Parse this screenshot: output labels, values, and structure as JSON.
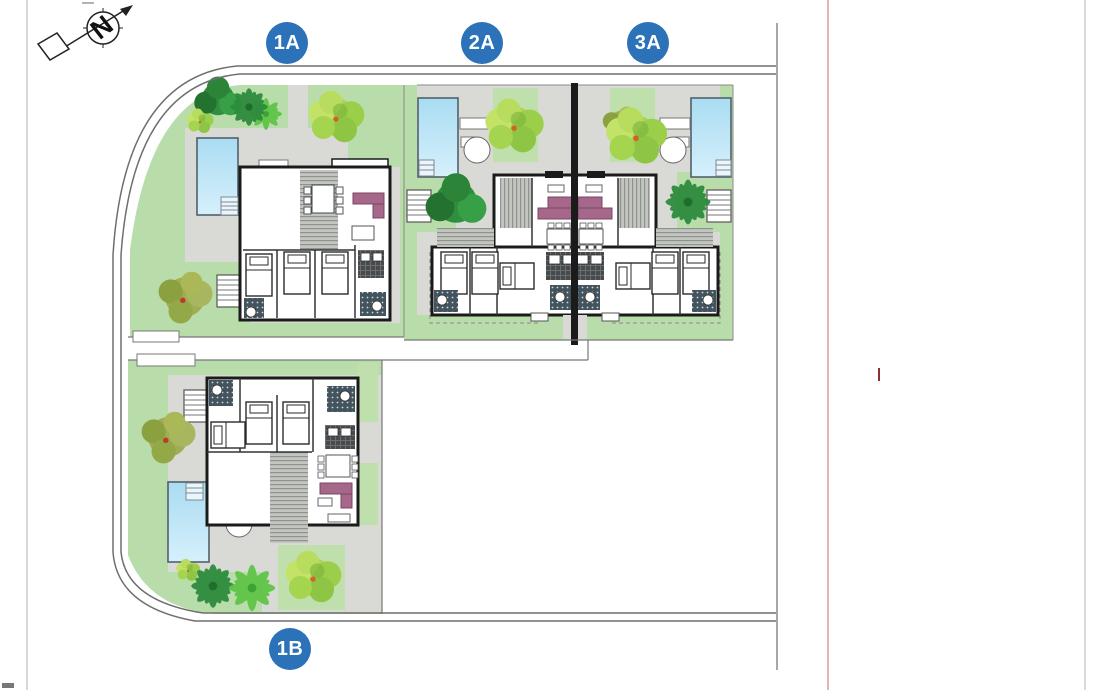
{
  "site_plan": {
    "compass": {
      "north_label": "N"
    },
    "units": [
      {
        "id": "unit-1a",
        "label": "1A"
      },
      {
        "id": "unit-2a",
        "label": "2A"
      },
      {
        "id": "unit-3a",
        "label": "3A"
      },
      {
        "id": "unit-1b",
        "label": "1B"
      }
    ]
  },
  "colors": {
    "accent": "#2b72b8",
    "lawn": "#b9dcab",
    "lawn_bright": "#bfe0ad",
    "terrace": "#d9dad5",
    "pool_top": "#a9dcf2",
    "pool_bottom": "#d6f0fb",
    "pool_border": "#51616b",
    "wall": "#1b1b1b",
    "road_line": "#6e6e6e",
    "boundary_gray": "#8a8a8a",
    "boundary_red": "#c96a6a",
    "boundary_red_dark": "#8c3030",
    "sofa": "#a5678a",
    "deck_bg": "#c2c5c0",
    "deck_line": "#8f938e",
    "bath": "#43545e",
    "kitchen": "#474b4d",
    "tree_dark": "#2e8b3d",
    "tree_light": "#9ed455",
    "tree_yellow": "#cbe35f",
    "tree_olive": "#93a83c"
  }
}
